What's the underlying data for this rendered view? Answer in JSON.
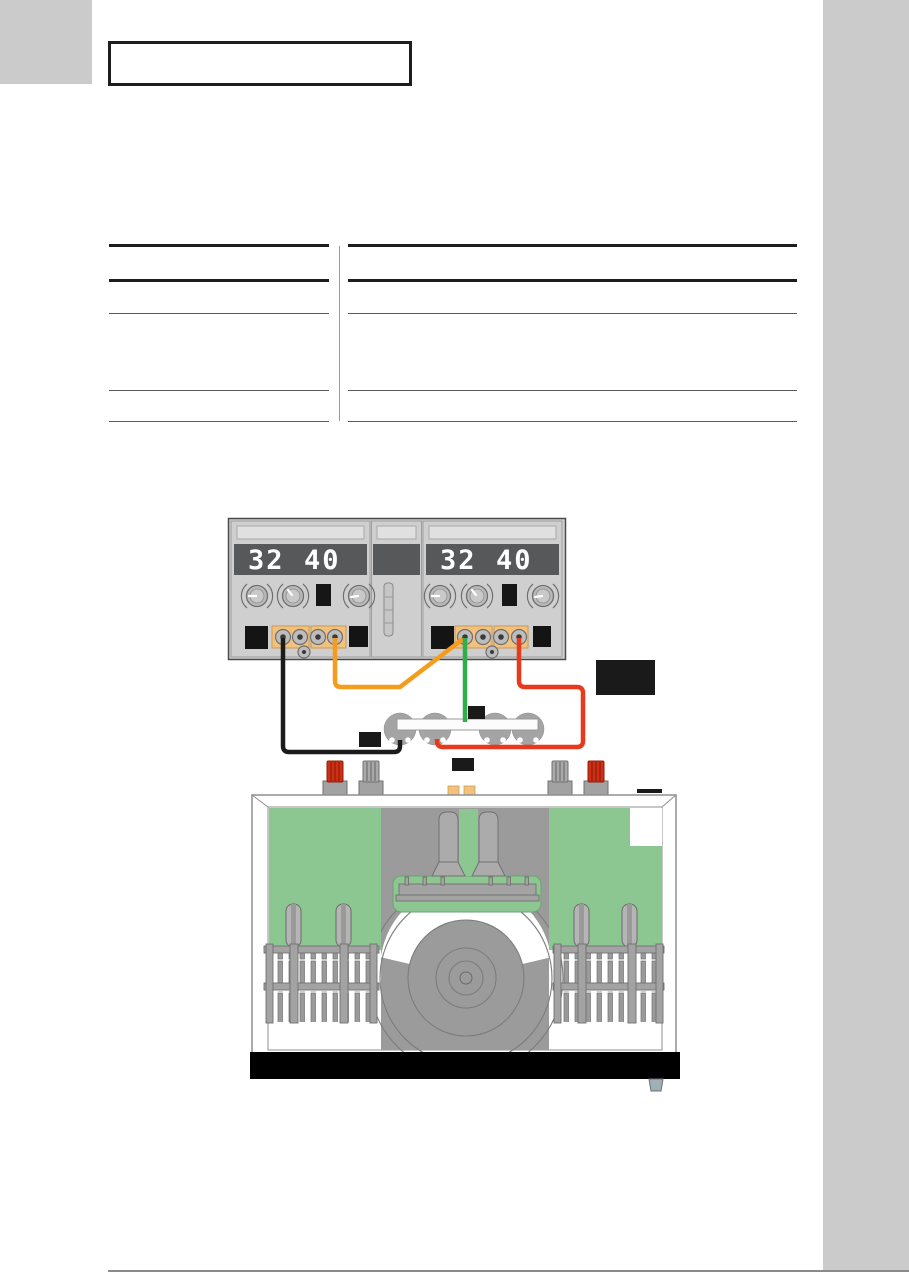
{
  "page": {
    "background": "#ffffff",
    "margin_block_color": "#cbcbcb",
    "footer_rule_color": "#8a8a8a"
  },
  "title_box": {
    "text": ""
  },
  "diagram": {
    "power_supply_left": {
      "display_value_1": "32",
      "display_value_2": "40"
    },
    "power_supply_right": {
      "display_value_1": "32",
      "display_value_2": "40"
    },
    "wires": {
      "black": "#1b1b1b",
      "orange": "#f59c1d",
      "green": "#2fae4a",
      "red": "#e8391d"
    },
    "colors": {
      "psu_body": "#cfcfcf",
      "display_band": "#57585a",
      "terminal_tan": "#f3c17e",
      "pcb_green": "#8cc791",
      "device_gray": "#9b9b9b",
      "post_red": "#cf2f15",
      "label_black": "#1a1a1a"
    }
  }
}
